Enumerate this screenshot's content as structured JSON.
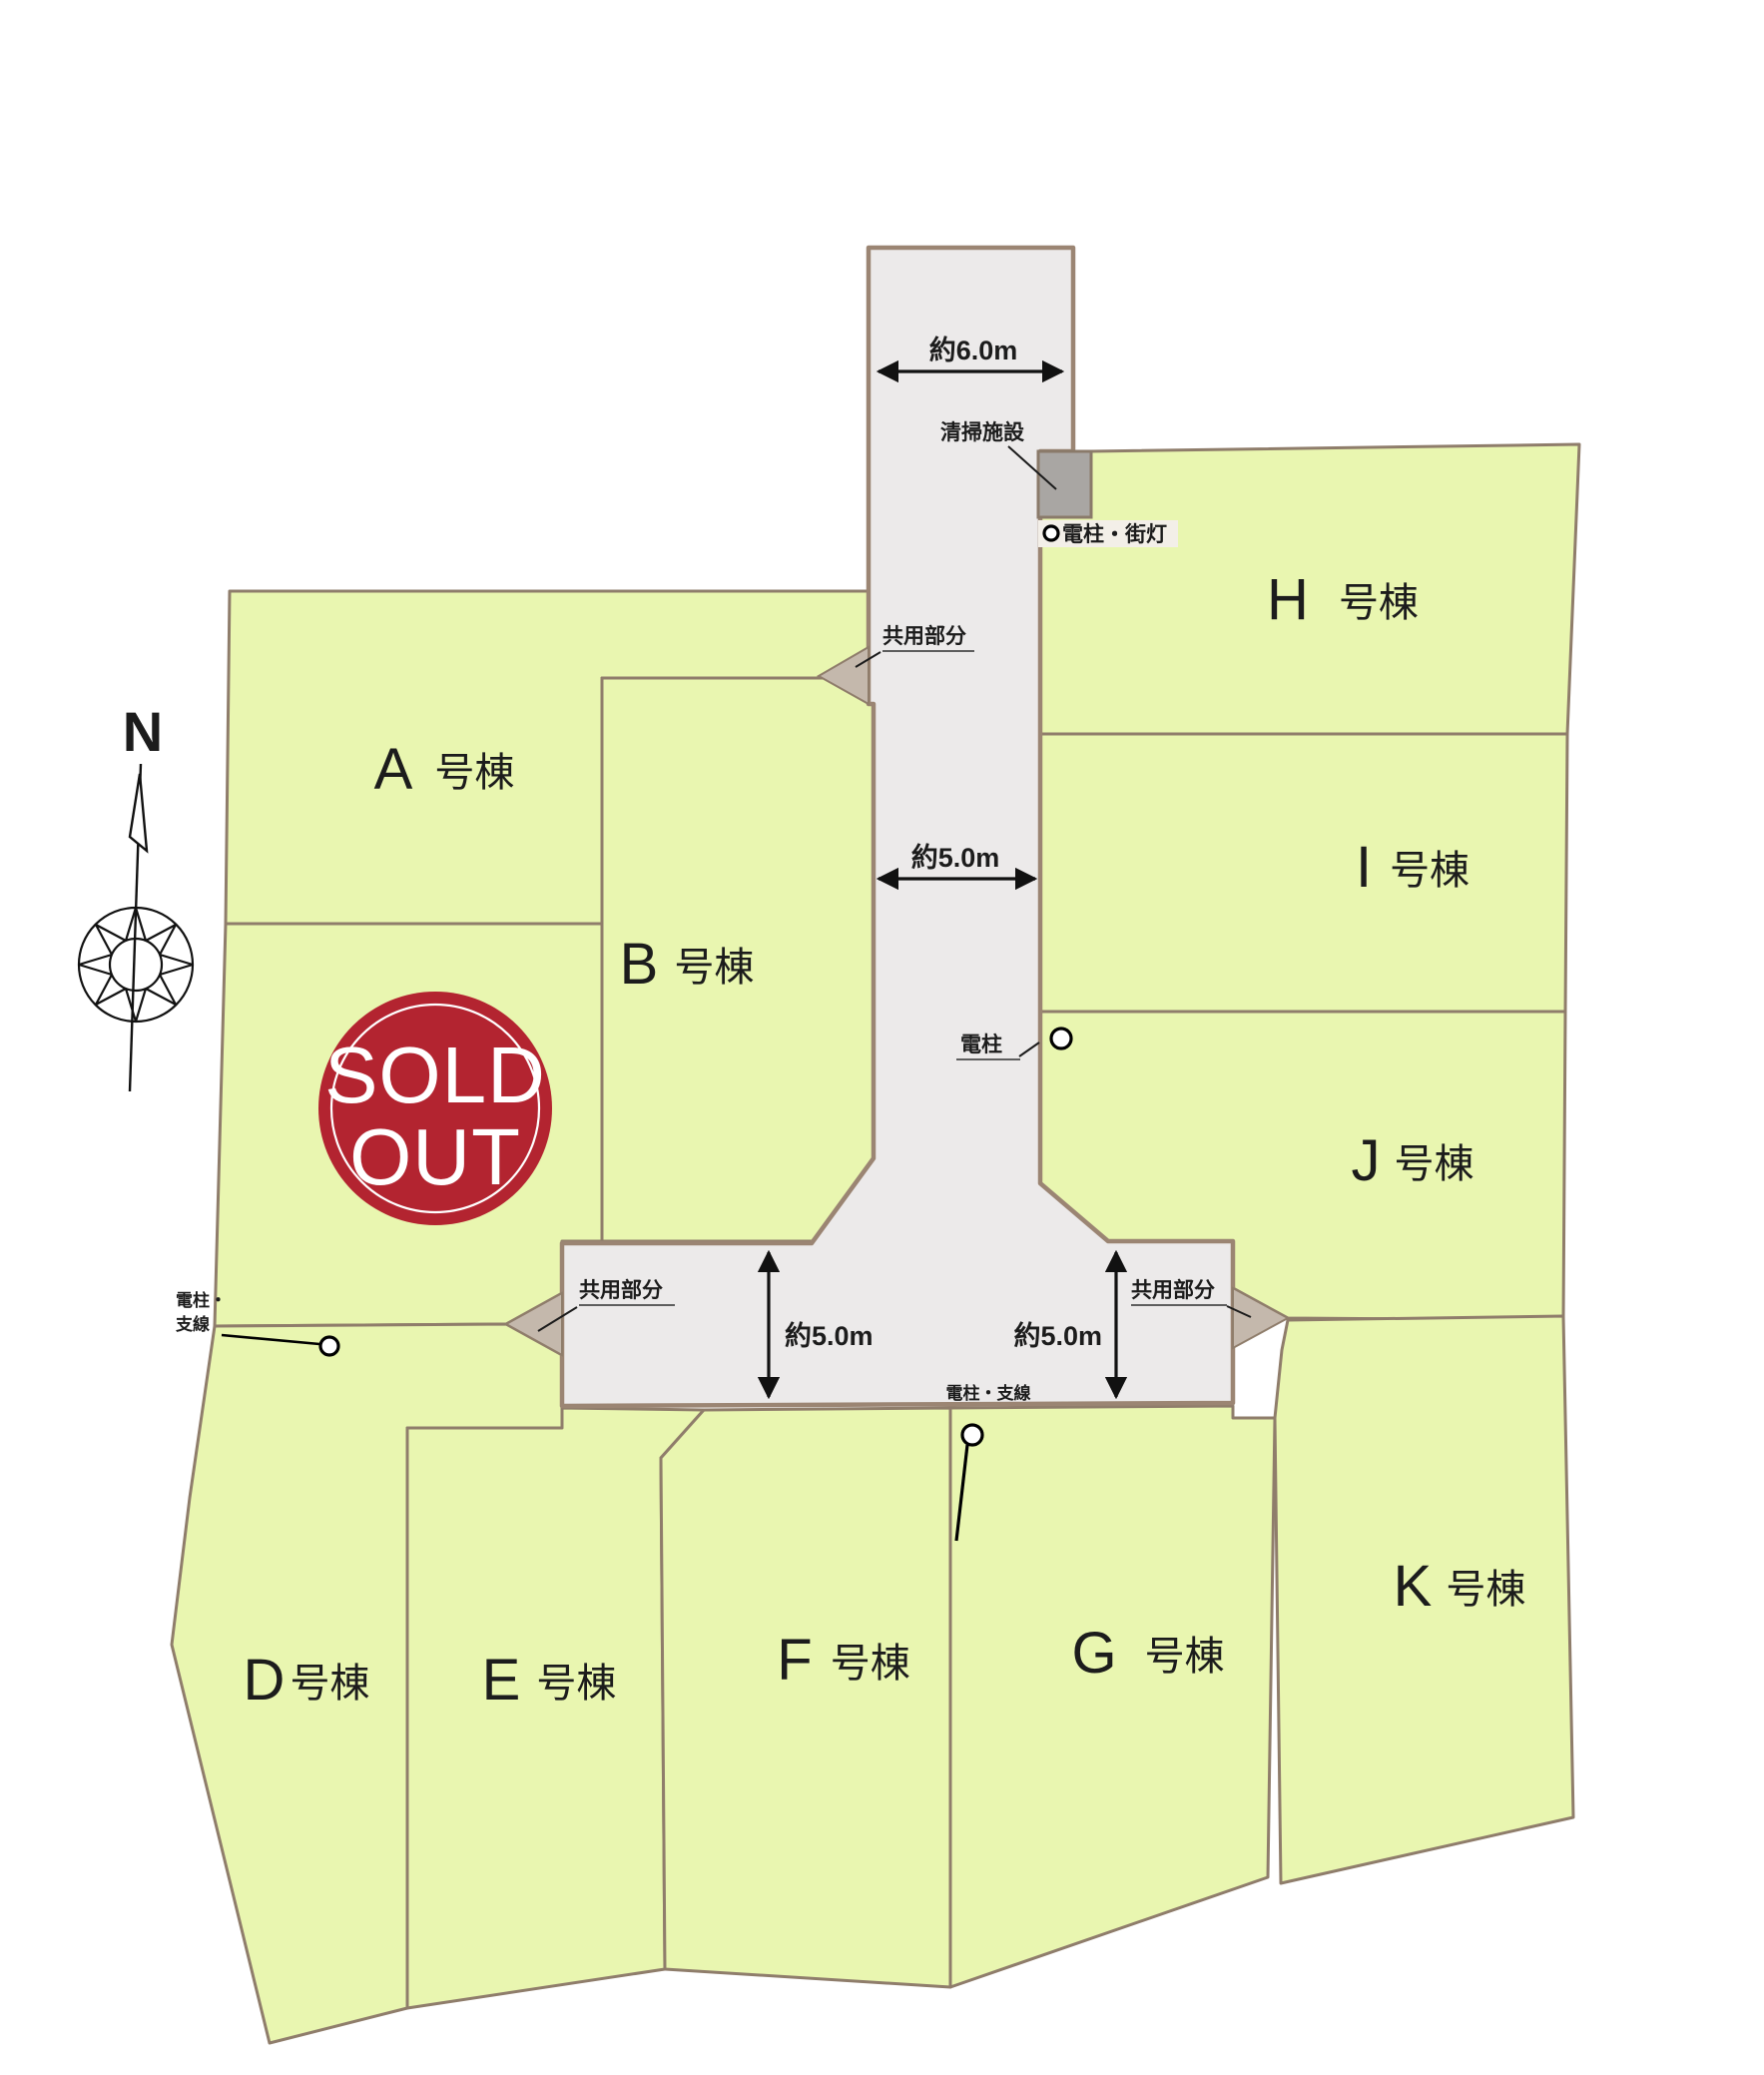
{
  "colors": {
    "lot_fill": "#E9F6B0",
    "road_fill": "#ECEAEA",
    "outer_border": "#9B8573",
    "lot_border": "#8F7D6B",
    "flare_fill": "#C4B8AC",
    "facility_fill": "#A9A6A3",
    "badge_red": "#B32430"
  },
  "compass": {
    "north_label": "N"
  },
  "sold_out_badge": {
    "line1": "SOLD",
    "line2": "OUT"
  },
  "lots": [
    {
      "id": "A",
      "letter": "A",
      "suffix": "号棟"
    },
    {
      "id": "B",
      "letter": "B",
      "suffix": "号棟"
    },
    {
      "id": "D",
      "letter": "D",
      "suffix": "号棟"
    },
    {
      "id": "E",
      "letter": "E",
      "suffix": "号棟"
    },
    {
      "id": "F",
      "letter": "F",
      "suffix": "号棟"
    },
    {
      "id": "G",
      "letter": "G",
      "suffix": "号棟"
    },
    {
      "id": "H",
      "letter": "H",
      "suffix": "号棟"
    },
    {
      "id": "I",
      "letter": "I",
      "suffix": "号棟"
    },
    {
      "id": "J",
      "letter": "J",
      "suffix": "号棟"
    },
    {
      "id": "K",
      "letter": "K",
      "suffix": "号棟"
    }
  ],
  "road": {
    "width_top_label": "約6.0m",
    "width_main_label": "約5.0m",
    "width_left_branch_label": "約5.0m",
    "width_right_branch_label": "約5.0m",
    "common_area_label": "共用部分"
  },
  "facilities": {
    "cleaning_facility_label": "清掃施設",
    "pole_streetlight_label": "電柱・街灯",
    "pole_label": "電柱",
    "pole_guywire_label": "電柱・支線",
    "pole_guywire_line1": "電柱・",
    "pole_guywire_line2": "支線"
  }
}
